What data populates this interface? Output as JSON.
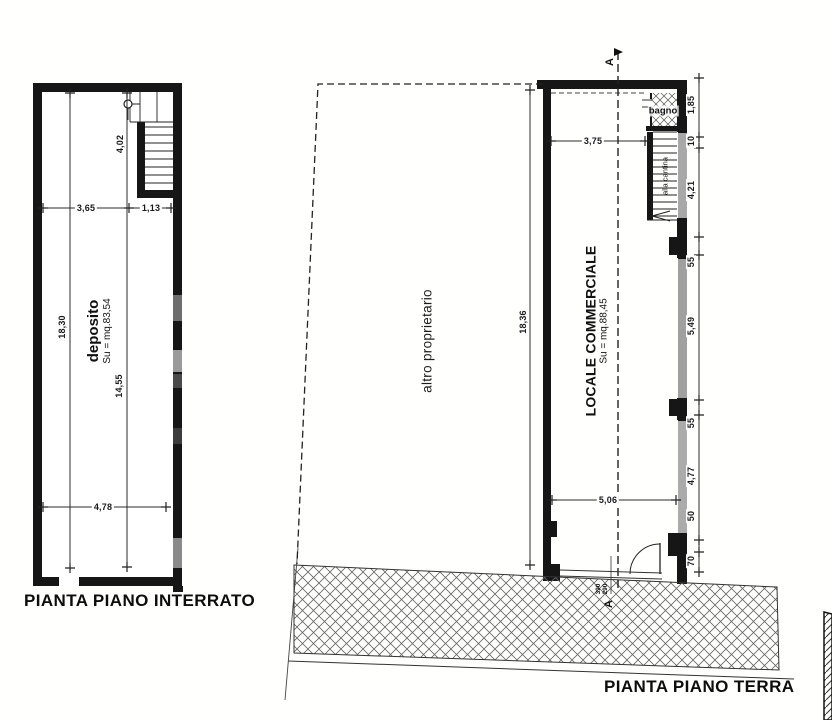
{
  "basement_plan": {
    "title": "PIANTA PIANO INTERRATO",
    "room_name": "deposito",
    "room_area": "Su = mq.83,54",
    "dims": {
      "total_height": "18,30",
      "upper_height": "4,02",
      "lower_height": "14,55",
      "top_width_left": "3,65",
      "top_width_right": "1,13",
      "bottom_width": "4,78"
    }
  },
  "ground_plan": {
    "title": "PIANTA PIANO TERRA",
    "parcel_label": "altro proprietario",
    "room_name": "LOCALE COMMERCIALE",
    "room_area": "Su = mq.88,45",
    "bath_label": "bagno",
    "stair_label": "alla cantina",
    "section_letter": "A",
    "door_note_line1": "390",
    "door_note_line2": "290",
    "dims": {
      "top_width": "3,75",
      "total_height": "18,36",
      "bottom_width": "5,06",
      "right_chain": [
        "1,85",
        "10",
        "4,21",
        "55",
        "5,49",
        "55",
        "4,77",
        "50",
        "70"
      ]
    }
  },
  "colors": {
    "ink": "#161616",
    "dim_line": "#2b2b2b",
    "hatch": "#666666"
  }
}
